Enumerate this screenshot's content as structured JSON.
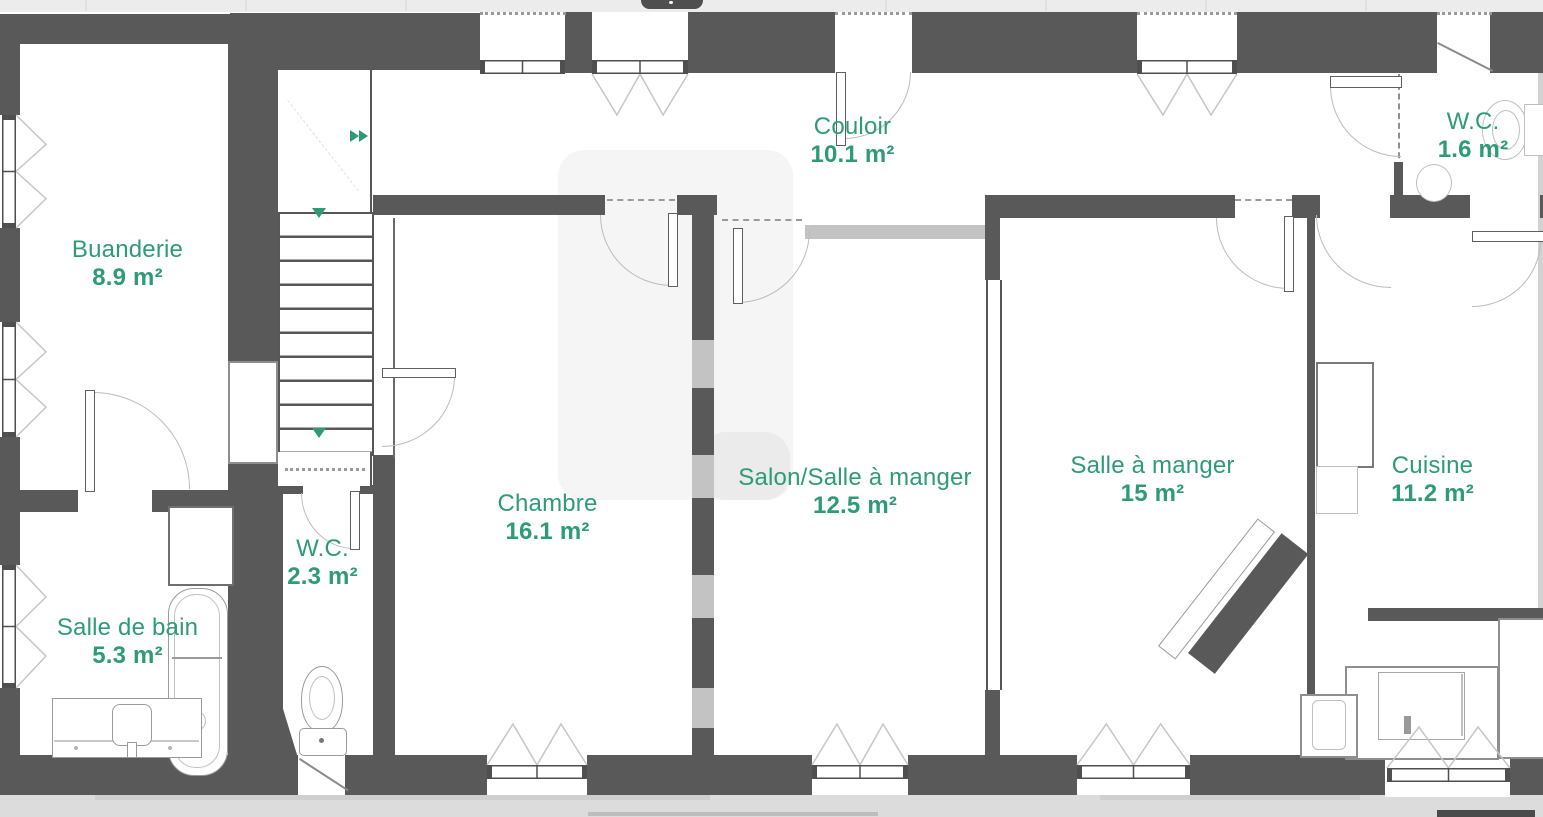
{
  "floorplan": {
    "accent_color": "#2E9B77",
    "wall_color": "#595959",
    "rooms": [
      {
        "label": "Buanderie",
        "area": "8.9 m²"
      },
      {
        "label": "Salle de bain",
        "area": "5.3 m²"
      },
      {
        "label": "W.C.",
        "area": "2.3 m²"
      },
      {
        "label": "Chambre",
        "area": "16.1 m²"
      },
      {
        "label": "Couloir",
        "area": "10.1 m²"
      },
      {
        "label": "Salon/Salle à manger",
        "area": "12.5 m²"
      },
      {
        "label": "Salle à manger",
        "area": "15 m²"
      },
      {
        "label": "Cuisine",
        "area": "11.2 m²"
      },
      {
        "label": "W.C.",
        "area": "1.6 m²"
      }
    ]
  }
}
